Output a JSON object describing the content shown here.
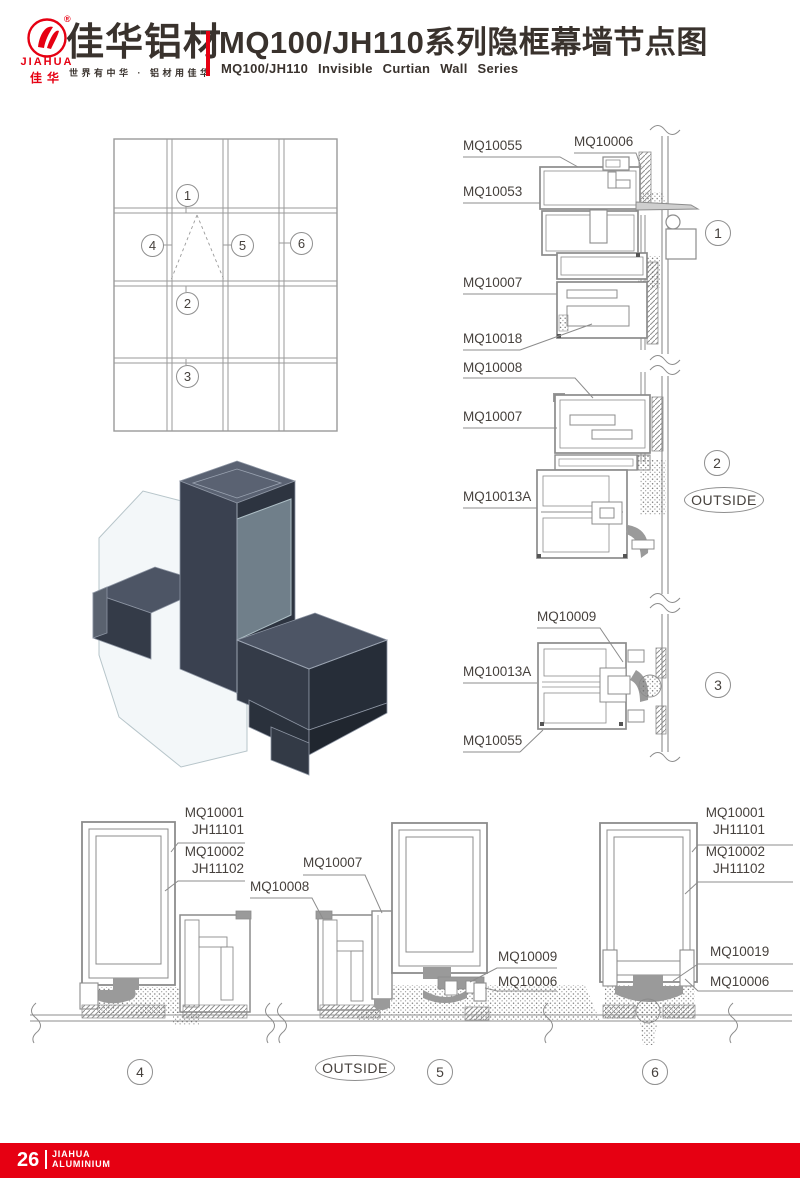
{
  "header": {
    "logo": {
      "reg": "®",
      "name_en": "JIAHUA",
      "name_cn_small": "佳华",
      "name_cn": "佳华铝材",
      "tagline": "世界有中华 · 铝材用佳华"
    },
    "title_cn": "MQ100/JH110系列隐框幕墙节点图",
    "title_en": "MQ100/JH110 Invisible Curtian Wall Series"
  },
  "callouts": {
    "c1": "1",
    "c2": "2",
    "c3": "3",
    "c4": "4",
    "c5": "5",
    "c6": "6"
  },
  "outside_label": "OUTSIDE",
  "labels": {
    "r1a": "MQ10055",
    "r1b": "MQ10006",
    "r1c": "MQ10053",
    "r1d": "MQ10007",
    "r1e": "MQ10018",
    "r2a": "MQ10008",
    "r2b": "MQ10007",
    "r2c": "MQ10013A",
    "r3a": "MQ10009",
    "r3b": "MQ10013A",
    "r3c": "MQ10055",
    "b4a1": "MQ10001",
    "b4a2": "JH11101",
    "b4b1": "MQ10002",
    "b4b2": "JH11102",
    "b4c": "MQ10008",
    "b5a": "MQ10007",
    "b5b": "MQ10009",
    "b5c": "MQ10006",
    "b6a1": "MQ10001",
    "b6a2": "JH11101",
    "b6b1": "MQ10002",
    "b6b2": "JH11102",
    "b6c": "MQ10019",
    "b6d": "MQ10006"
  },
  "footer": {
    "page_number": "26",
    "brand_line1": "JIAHUA",
    "brand_line2": "ALUMINIUM"
  },
  "colors": {
    "brand_red": "#e60012",
    "line_gray": "#8f8f8f",
    "text_dark": "#39322d"
  }
}
